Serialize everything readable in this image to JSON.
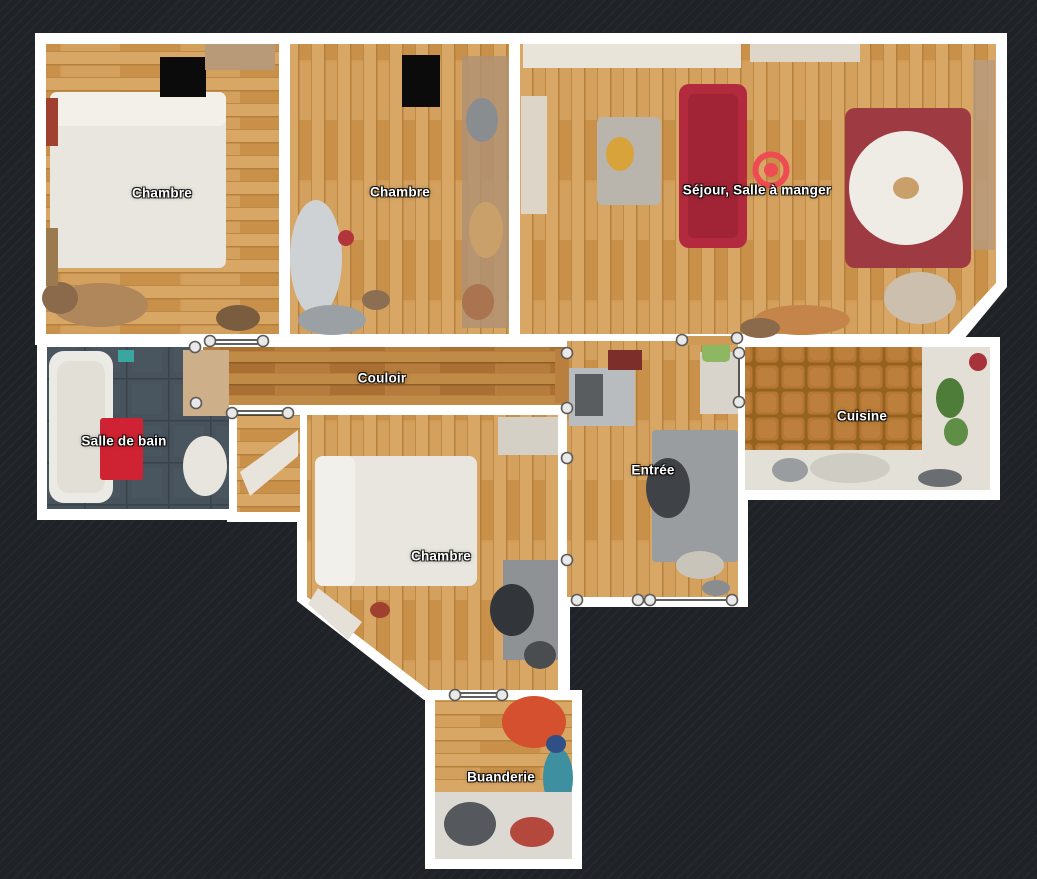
{
  "app": {
    "name": "floorplan-viewer",
    "view": "top-down-floor-plan"
  },
  "colors": {
    "background": "#1f2227",
    "wall": "#ffffff",
    "marker_red": "#ef4b52",
    "wood_light": "#d6a361",
    "wood_corridor": "#b97f3e",
    "kitchen_tile": "#b57733",
    "bathroom_tile": "#47525c",
    "label_text": "#ffffff"
  },
  "rooms": [
    {
      "id": "chambre-1",
      "label": "Chambre"
    },
    {
      "id": "chambre-2",
      "label": "Chambre"
    },
    {
      "id": "sejour-salle-a-manger",
      "label": "Séjour, Salle à manger"
    },
    {
      "id": "couloir",
      "label": "Couloir"
    },
    {
      "id": "salle-de-bain",
      "label": "Salle de bain"
    },
    {
      "id": "entree",
      "label": "Entrée"
    },
    {
      "id": "cuisine",
      "label": "Cuisine"
    },
    {
      "id": "chambre-3",
      "label": "Chambre"
    },
    {
      "id": "buanderie",
      "label": "Buanderie"
    }
  ],
  "marker": {
    "room": "sejour-salle-a-manger",
    "color": "#ef4b52",
    "type": "camera-position"
  }
}
